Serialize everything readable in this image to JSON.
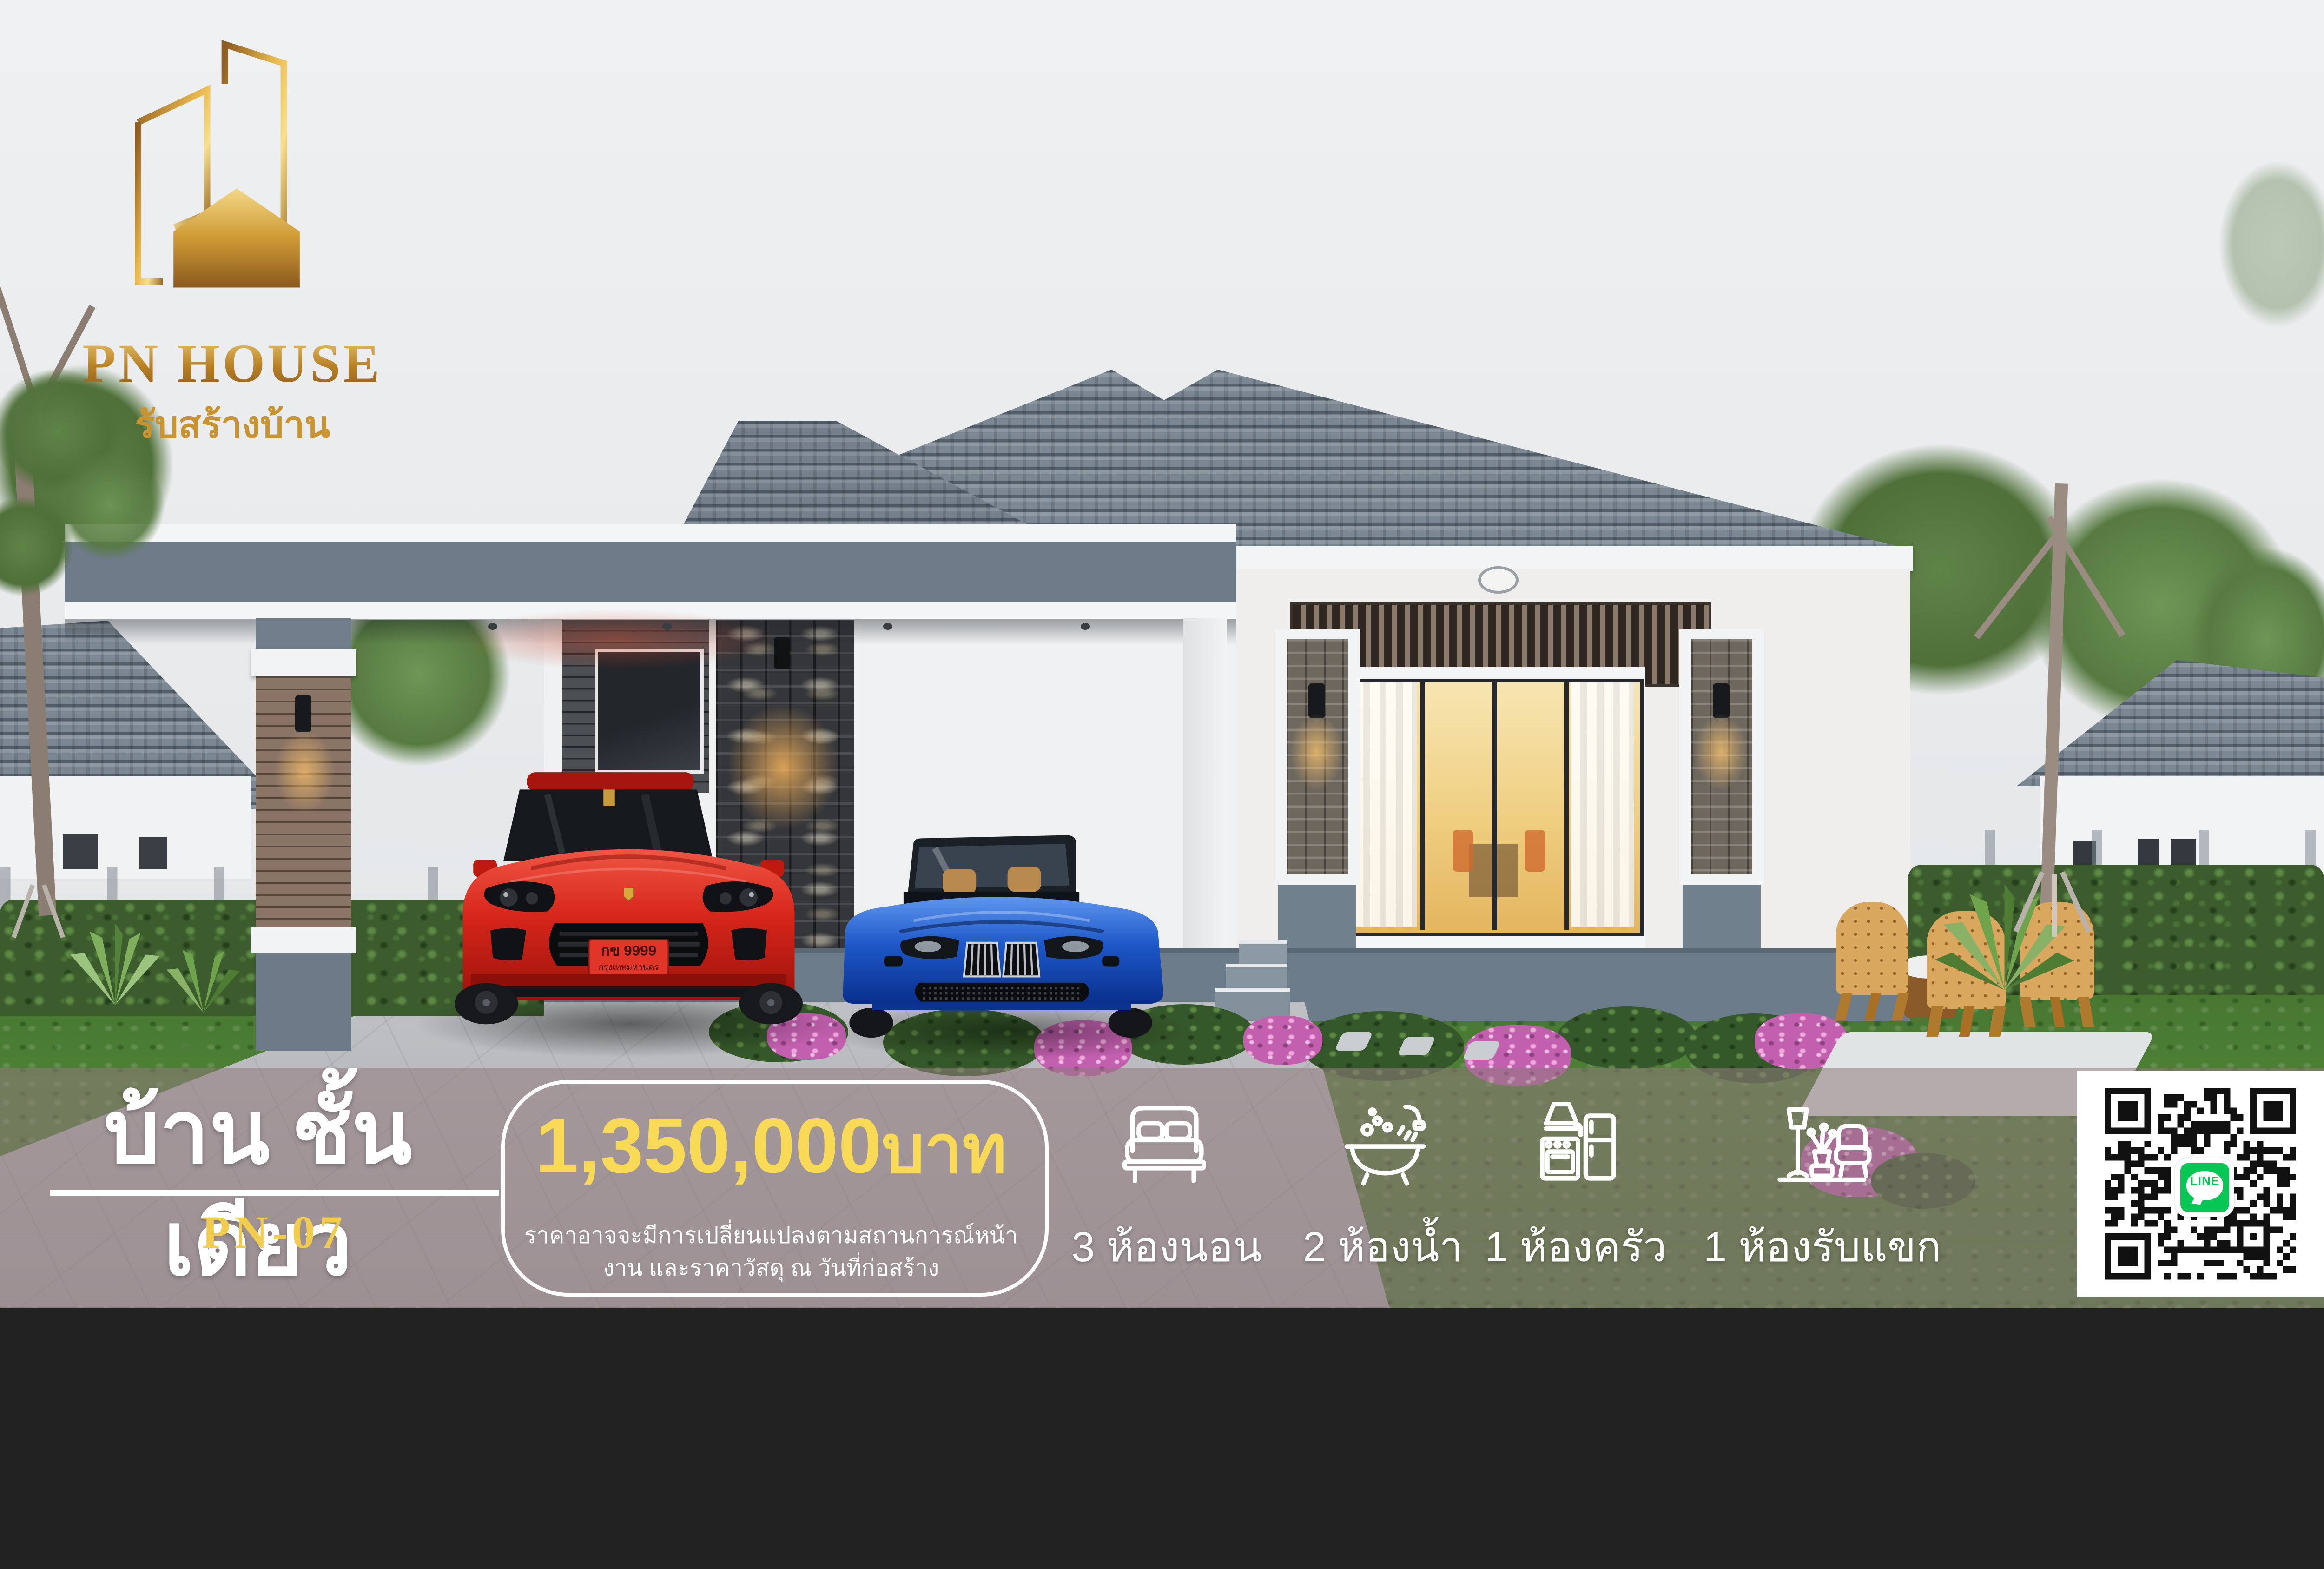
{
  "brand": {
    "name": "PN HOUSE",
    "tagline": "รับสร้างบ้าน"
  },
  "banner": {
    "title": "บ้าน ชั้นเดียว",
    "model_code": "PN-07",
    "price_amount": "1,350,000",
    "price_unit": "บาท",
    "price_note_line1": "ราคาอาจจะมีการเปลี่ยนแปลงตามสถานการณ์หน้า",
    "price_note_line2": "งาน และราคาวัสดุ ณ วันที่ก่อสร้าง",
    "features": [
      {
        "icon": "bed-icon",
        "count": "3",
        "label": "ห้องนอน"
      },
      {
        "icon": "bathtub-icon",
        "count": "2",
        "label": "ห้องน้ำ"
      },
      {
        "icon": "kitchen-icon",
        "count": "1",
        "label": "ห้องครัว"
      },
      {
        "icon": "sofa-lamp-icon",
        "count": "1",
        "label": "ห้องรับแขก"
      }
    ]
  },
  "qr_badge": {
    "label": "LINE"
  },
  "vehicle": {
    "license_plate_line1": "กข 9999",
    "license_plate_line2": "กรุงเทพมหานคร"
  },
  "colors": {
    "accent_yellow": "#f8da57",
    "model_code_yellow": "#f2cc4c",
    "line_green": "#06c755",
    "banner_overlay": "rgba(145,122,126,0.55)",
    "gold": "#c9932f"
  }
}
